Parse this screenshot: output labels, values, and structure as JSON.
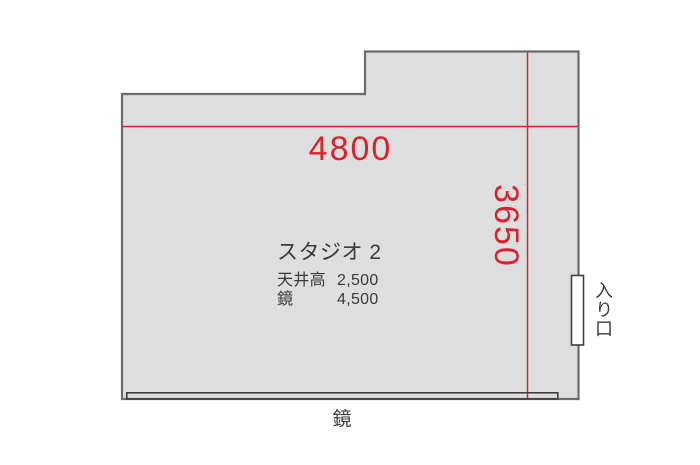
{
  "floorplan": {
    "title": "スタジオ 2",
    "width_dimension": "4800",
    "height_dimension": "3650",
    "specs": [
      {
        "label": "天井高",
        "value": "2,500"
      },
      {
        "label": "鏡",
        "value": "4,500"
      }
    ],
    "mirror_label": "鏡",
    "entrance_label": "入り口",
    "colors": {
      "dimension_red": "#d8232e",
      "room_fill": "#dedede",
      "wall_stroke": "#6a6a6a",
      "detail_stroke": "#3f3f3f",
      "text_dark": "#3a3a3a"
    }
  }
}
